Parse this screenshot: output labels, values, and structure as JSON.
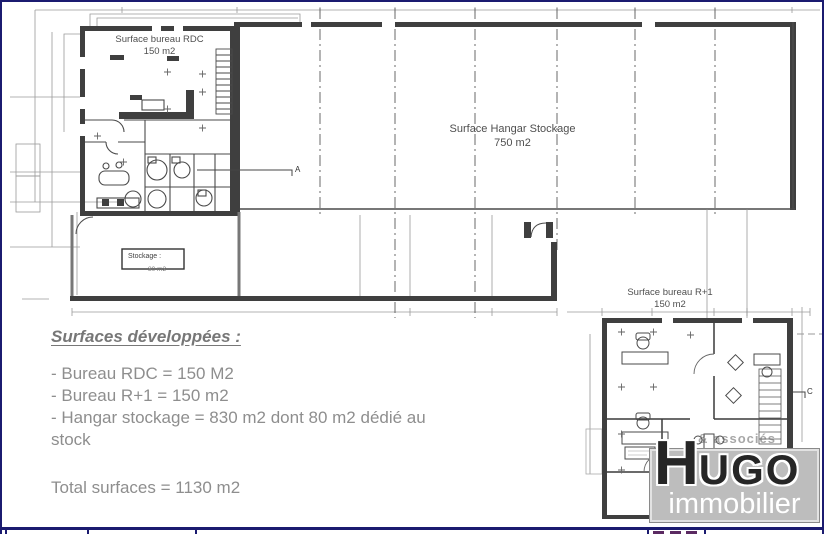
{
  "plans": {
    "rdc": {
      "title": "Surface bureau RDC",
      "area": "150 m2"
    },
    "hangar": {
      "title": "Surface Hangar Stockage",
      "area": "750 m2"
    },
    "stockage": {
      "title": "Stockage :",
      "area": "80 m2"
    },
    "r1": {
      "title": "Surface bureau R+1",
      "area": "150 m2"
    },
    "marker_a": "A",
    "marker_c": "C"
  },
  "summary": {
    "heading": "Surfaces développées :",
    "items": [
      "- Bureau RDC = 150 M2",
      "- Bureau R+1 = 150 m2",
      "- Hangar stockage = 830 m2 dont 80 m2 dédié au stock"
    ],
    "total": "Total surfaces = 1130 m2"
  },
  "logo": {
    "tagline": "& associés",
    "word_initial": "H",
    "word_rest": "UGO",
    "subtitle": "immobilier"
  },
  "colors": {
    "frame_navy": "#1b1b70",
    "wall_dark": "#3f3f3f",
    "dimension_gray": "#8a8a8a",
    "summary_text_gray": "#8e8e8e",
    "logo_box_gray": "#bdbdbd",
    "logo_text_dark": "#262626",
    "title_block_marks_purple": "#5b2a62"
  }
}
